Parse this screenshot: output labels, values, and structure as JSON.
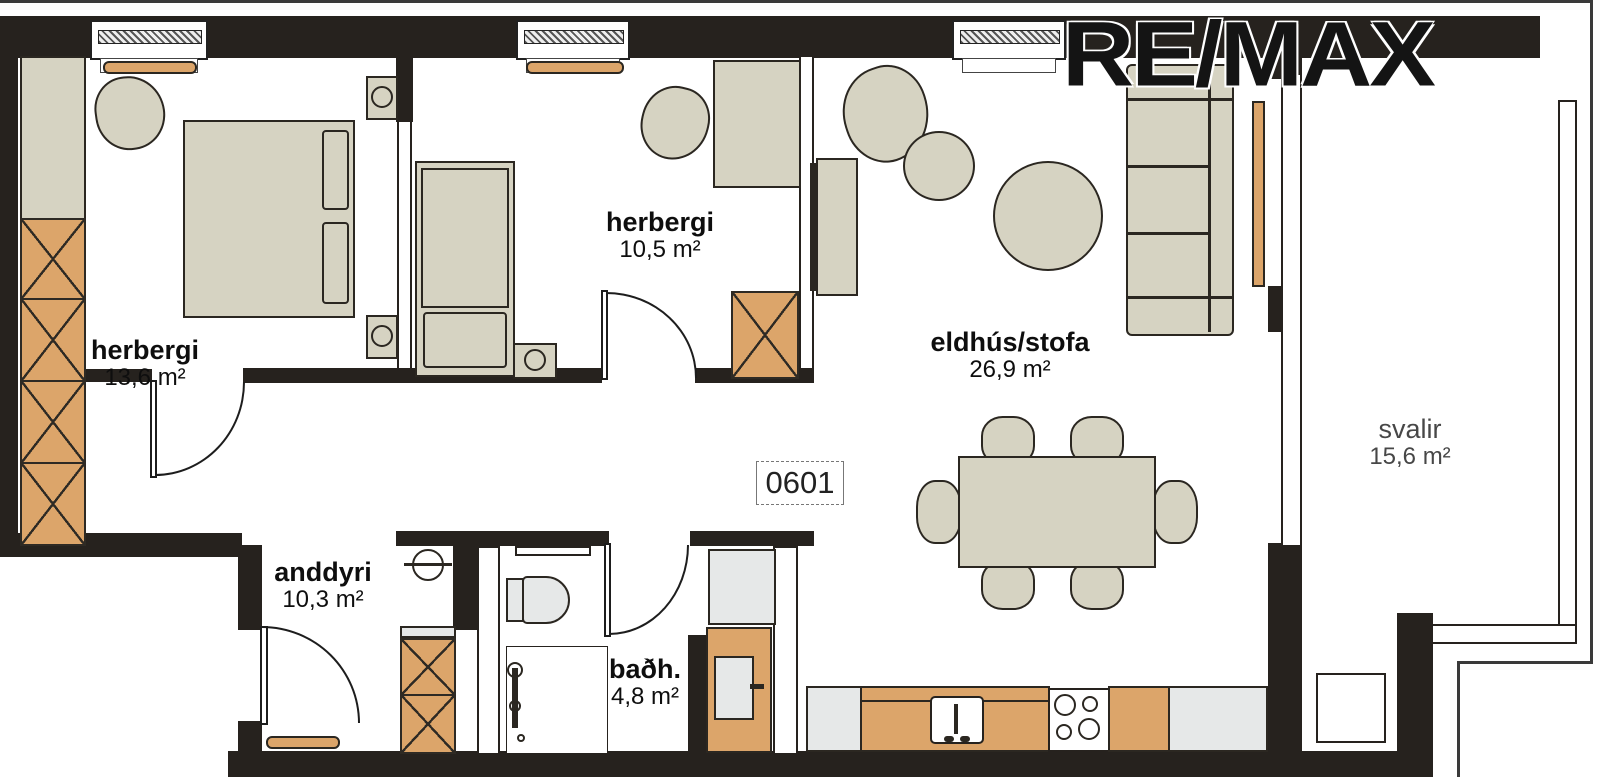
{
  "watermark": "RE/MAX",
  "unit_number": "0601",
  "rooms": {
    "bedroom1": {
      "name": "herbergi",
      "area": "13,6 m²"
    },
    "bedroom2": {
      "name": "herbergi",
      "area": "10,5 m²"
    },
    "living": {
      "name": "eldhús/stofa",
      "area": "26,9 m²"
    },
    "hall": {
      "name": "anddyri",
      "area": "10,3 m²"
    },
    "bath": {
      "name": "baðh.",
      "area": "4,8 m²"
    },
    "balcony": {
      "name": "svalir",
      "area": "15,6 m²"
    }
  },
  "colors": {
    "wall": "#26221e",
    "wood_accent": "#dca56a",
    "furniture": "#d6d3c2",
    "appliance_grey": "#e6e8e8",
    "label_text": "#0e0e0e",
    "balcony_label_text": "#474747"
  }
}
